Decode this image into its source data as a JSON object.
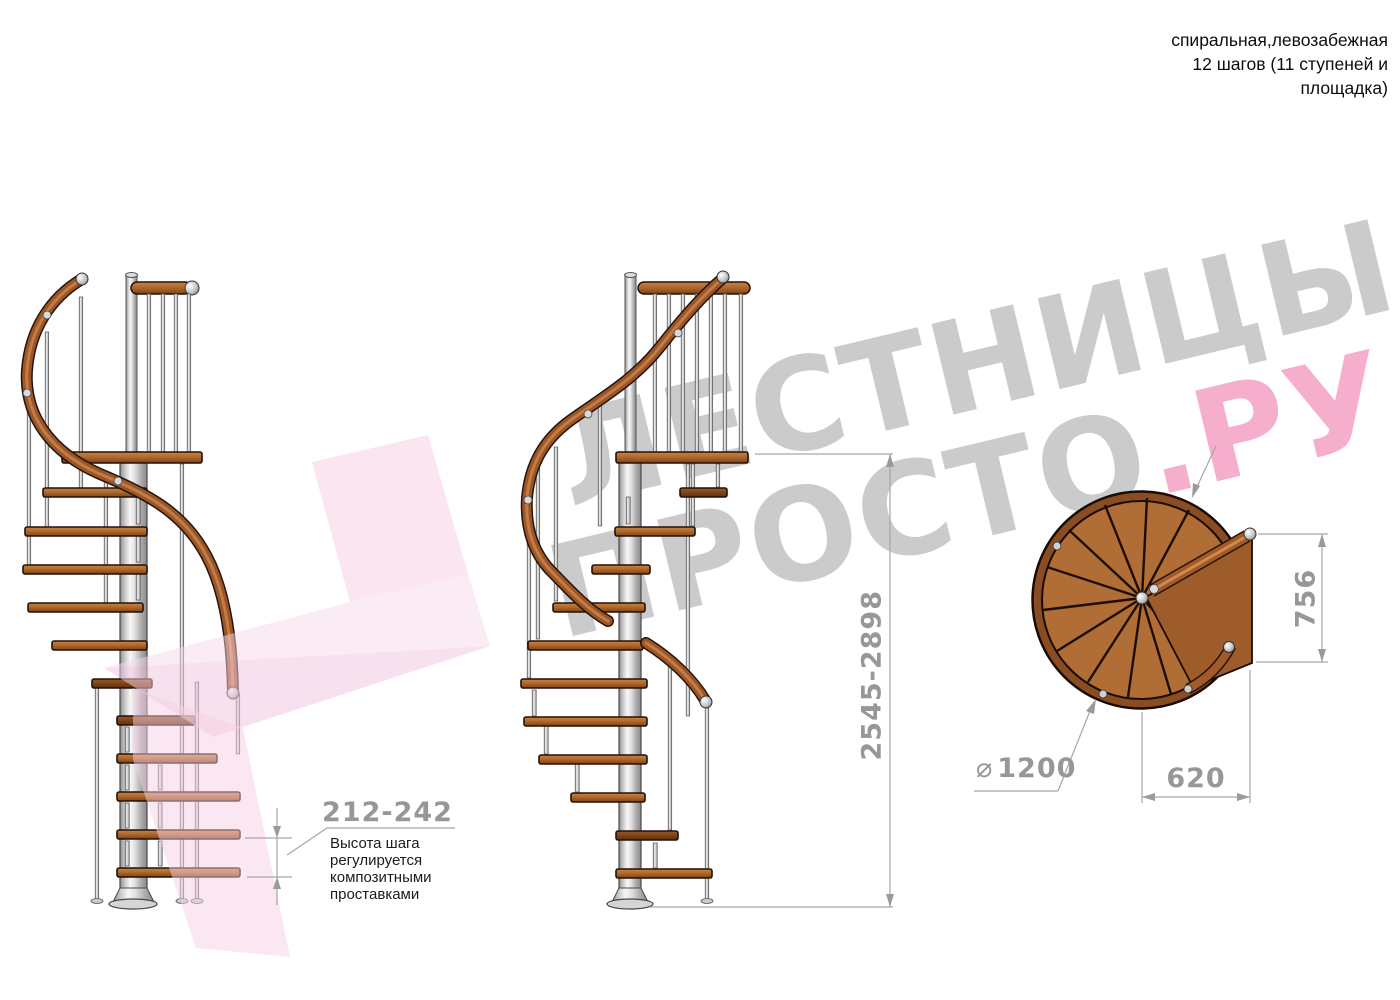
{
  "header": {
    "line1": "спиральная,левозабежная",
    "line2": "12 шагов (11 ступеней и",
    "line3": "площадка)"
  },
  "watermark": {
    "line1": "ЛЕСТНИЦЫ",
    "line2_gray": "ПРОСТО",
    "line2_pink": ".РУ",
    "gray_color": "#cccbcb",
    "pink_color": "#f6aecd",
    "arrow_pink": "#f6cfe4"
  },
  "dimensions": {
    "step_height": {
      "value": "212-242",
      "note": "Высота шага\nрегулируется\nкомпозитными\nпроставками"
    },
    "total_height": {
      "value": "2545-2898"
    },
    "platform_depth": {
      "value": "756"
    },
    "platform_width": {
      "value": "620"
    },
    "diameter": {
      "symbol": "⌀",
      "value": "1200"
    }
  },
  "colors": {
    "wood": "#b06a2f",
    "wood_dark": "#7c4315",
    "metal": "#e8e8e8",
    "dimension_gray": "#979797",
    "outline": "#241106"
  }
}
